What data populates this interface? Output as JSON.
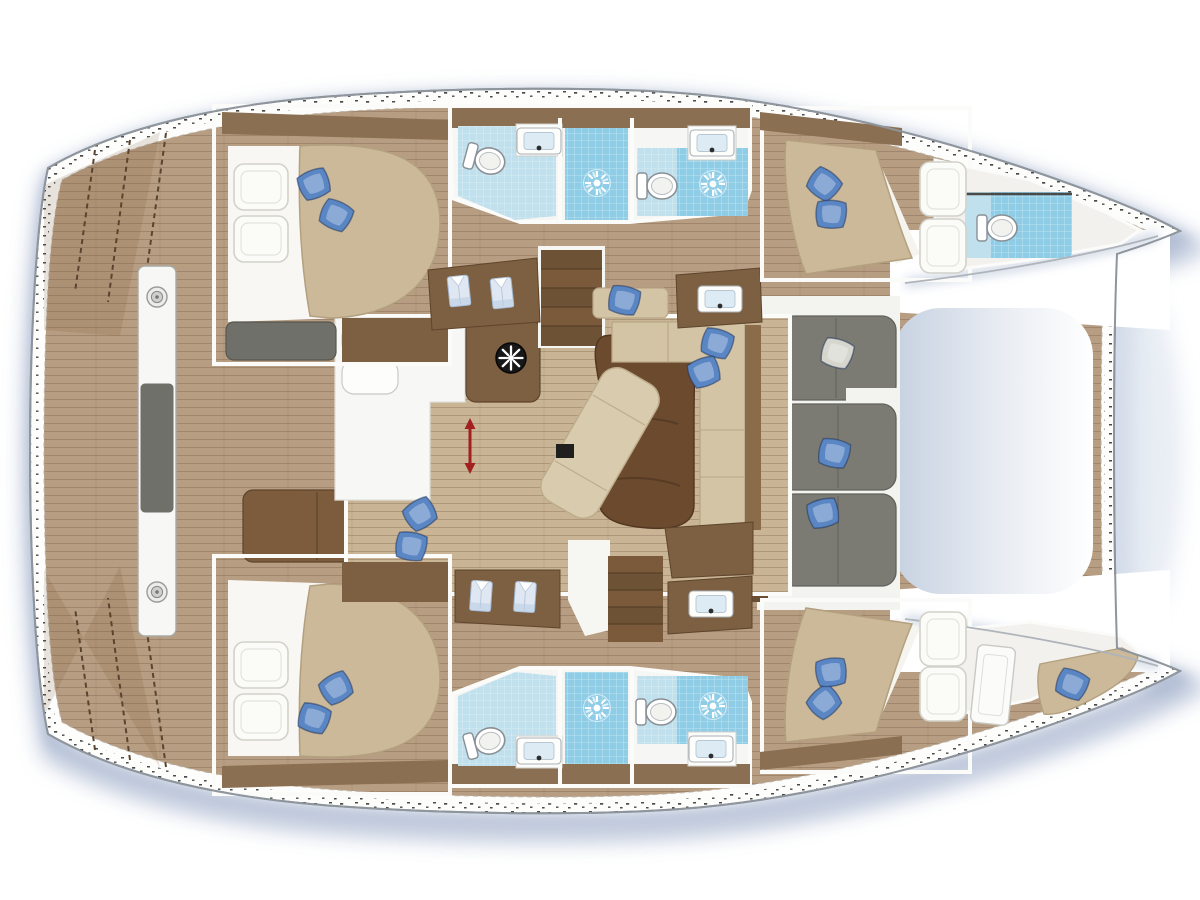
{
  "diagram": {
    "type": "boat-floorplan",
    "subject": "catamaran interior layout, top-down deck plan",
    "orientation": "bows to the right, transoms to the left",
    "hulls": 2
  },
  "colors": {
    "bg": "#ffffff",
    "hull_fill": "#fdfdfc",
    "hull_line": "#8e959c",
    "deck_wood": "#b79d81",
    "saloon_wood": "#c9b496",
    "wood_dark": "#8a6f52",
    "wood_furniture": "#7d5f41",
    "wood_table": "#6b4a2e",
    "bulkhead": "#6b4f33",
    "mattress": "#cbb999",
    "mattress_line": "#b3a07f",
    "sheet": "#f8f7f4",
    "bed_pillow": "#fbfbf8",
    "pillow_blue": "#5b86c4",
    "pillow_white": "#d6d6ce",
    "gray_cushion": "#7b7b74",
    "gray_bench": "#70706a",
    "tile_light": "#bfe0ec",
    "tile_mid": "#8fcde7",
    "bath_white": "#f6f6f4",
    "room_white": "#f2f1ee",
    "trampoline_edge": "#c6d1e1",
    "trampoline_fade": "#ffffff",
    "shadow": "#7e92b8",
    "arrow_red": "#a32020",
    "black": "#1f1f1f",
    "wall": "#fbfbf9"
  },
  "rooms": [
    {
      "id": "aft-cabin-port",
      "name": "double cabin aft port (top left)"
    },
    {
      "id": "bathroom-port-aft",
      "name": "bathroom with toilet, sink and shower (port)"
    },
    {
      "id": "bathroom-port-fwd",
      "name": "bathroom with toilet, sink and shower (port fwd)"
    },
    {
      "id": "fwd-cabin-port",
      "name": "double cabin forward port (top right)"
    },
    {
      "id": "bow-head-port",
      "name": "forepeak head with toilet and shower tray (port bow)"
    },
    {
      "id": "saloon",
      "name": "bridgedeck saloon with galley, helm console, dining table and chaise"
    },
    {
      "id": "aft-cockpit",
      "name": "aft cockpit with bench, table and transom arch"
    },
    {
      "id": "fwd-cockpit",
      "name": "forward cockpit with gray lounge sofa"
    },
    {
      "id": "trampoline",
      "name": "bow trampoline"
    },
    {
      "id": "aft-cabin-stbd",
      "name": "double cabin aft starboard (bottom left)"
    },
    {
      "id": "bathroom-stbd-aft",
      "name": "bathroom with toilet, sink and shower (stbd)"
    },
    {
      "id": "bathroom-stbd-fwd",
      "name": "bathroom with toilet, sink and shower (stbd fwd)"
    },
    {
      "id": "fwd-cabin-stbd",
      "name": "double cabin forward starboard (bottom right)"
    },
    {
      "id": "bow-berth-stbd",
      "name": "forepeak single berth (stbd bow)"
    }
  ],
  "inventory": {
    "double_cabins": 4,
    "bathrooms": 4,
    "showers": 4,
    "toilets": 5,
    "sinks": 6,
    "forepeak_berths": 1,
    "wardrobes_with_shirts": 2,
    "companionway_stairs": 2,
    "blue_throw_pillows": 16,
    "cockpits": 2
  },
  "legend_icons": [
    "helm-wheel-icon",
    "shower-drain-icon",
    "toilet-icon",
    "sink-icon",
    "shirt-wardrobe-icon",
    "pillow-icon",
    "headroom-arrow-icon",
    "stairs-icon"
  ],
  "placements": {
    "blue_pillow": {
      "symbol": "sym-pillow",
      "name": "blue-pillow",
      "color": "#5b86c4",
      "spots": [
        [
          314,
          184,
          -20
        ],
        [
          336,
          215,
          28
        ],
        [
          824,
          184,
          40
        ],
        [
          831,
          214,
          5
        ],
        [
          624,
          300,
          15
        ],
        [
          717,
          343,
          20
        ],
        [
          704,
          372,
          -18
        ],
        [
          420,
          514,
          -30
        ],
        [
          411,
          546,
          12
        ],
        [
          834,
          453,
          15
        ],
        [
          823,
          513,
          -12
        ],
        [
          314,
          718,
          20
        ],
        [
          336,
          688,
          -28
        ],
        [
          824,
          702,
          -40
        ],
        [
          831,
          672,
          -5
        ],
        [
          1072,
          684,
          25
        ]
      ]
    },
    "white_throw_pillow": {
      "symbol": "sym-pillow",
      "name": "white-pillow",
      "color": "#d6d6ce",
      "spots": [
        [
          837,
          353,
          20
        ]
      ]
    },
    "bed_pillow": {
      "symbol": "sym-bedpillow",
      "name": "bed-pillow",
      "spots": [
        [
          261,
          187,
          0
        ],
        [
          261,
          239,
          0
        ],
        [
          261,
          665,
          0
        ],
        [
          261,
          717,
          0
        ],
        [
          943,
          189,
          90
        ],
        [
          943,
          246,
          90
        ],
        [
          943,
          639,
          90
        ],
        [
          943,
          694,
          90
        ]
      ]
    },
    "shower_drain": {
      "symbol": "sym-sun",
      "name": "shower-drain-icon",
      "spots": [
        [
          597,
          183,
          0
        ],
        [
          713,
          184,
          0
        ],
        [
          597,
          708,
          0
        ],
        [
          713,
          706,
          0
        ]
      ]
    },
    "toilet": {
      "symbol": "sym-toilet",
      "name": "toilet-icon",
      "spots": [
        [
          486,
          160,
          -75
        ],
        [
          658,
          186,
          -90
        ],
        [
          998,
          228,
          -90
        ],
        [
          486,
          742,
          -105
        ],
        [
          657,
          712,
          -90
        ]
      ]
    },
    "sink": {
      "symbol": "sym-sink",
      "name": "sink-icon",
      "spots": [
        [
          539,
          141,
          0
        ],
        [
          712,
          143,
          0
        ],
        [
          539,
          751,
          0
        ],
        [
          711,
          749,
          0
        ],
        [
          720,
          299,
          0
        ],
        [
          711,
          604,
          0
        ]
      ]
    },
    "wardrobe_shirt": {
      "symbol": "sym-shirt",
      "name": "shirt-wardrobe-icon",
      "spots": [
        [
          459,
          291,
          -6
        ],
        [
          502,
          293,
          -6
        ],
        [
          481,
          596,
          4
        ],
        [
          525,
          597,
          4
        ]
      ]
    },
    "arch_fitting": {
      "symbol": "sym-fitting",
      "name": "winch-fitting-icon",
      "spots": [
        [
          157,
          297,
          0
        ],
        [
          157,
          592,
          0
        ]
      ]
    }
  }
}
